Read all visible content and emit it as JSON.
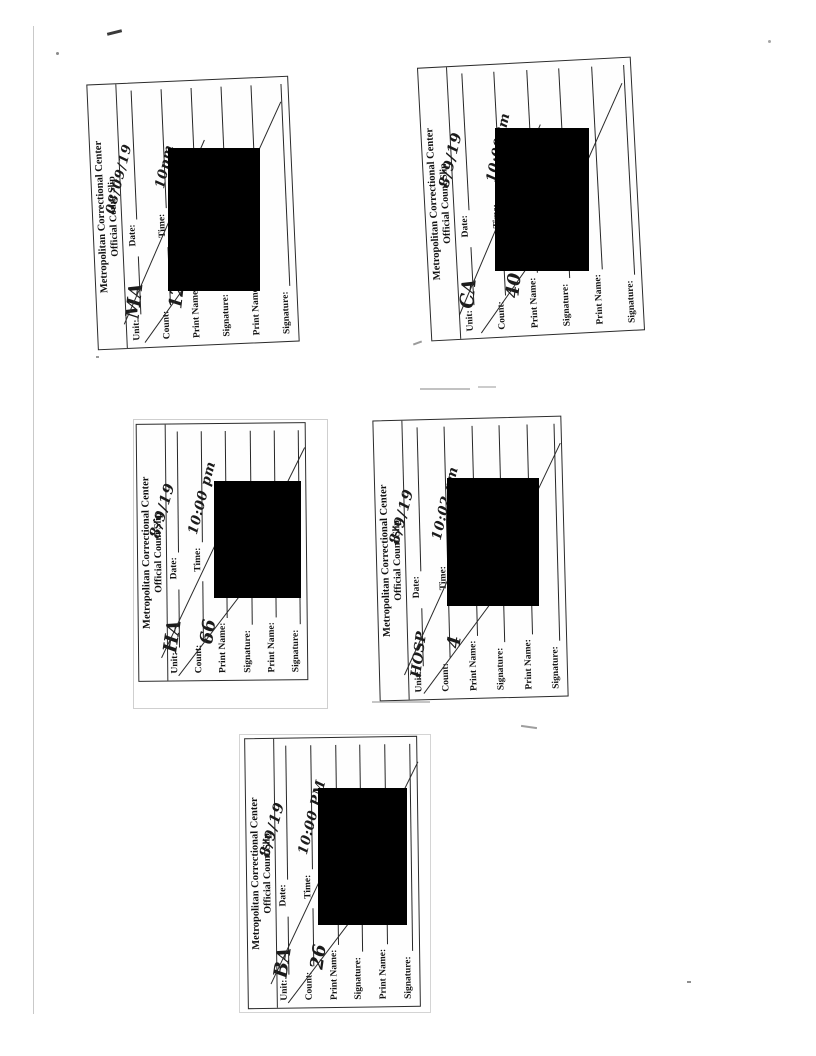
{
  "slip": {
    "header_line1": "Metropolitan Correctional Center",
    "header_line2": "Official Count Slip",
    "labels": {
      "unit": "Unit:",
      "date": "Date:",
      "count": "Count:",
      "time": "Time:",
      "print_name": "Print Name:",
      "signature": "Signature:"
    }
  },
  "slips": [
    {
      "unit": "MA",
      "count": "125",
      "date": "08/09/19",
      "time": "10pm"
    },
    {
      "unit": "CA",
      "count": "40",
      "date": "8/9/19",
      "time": "10:00Pm"
    },
    {
      "unit": "HA",
      "count": "66",
      "date": "8/9/19",
      "time": "10:00 pm"
    },
    {
      "unit": "HOSP",
      "count": "4",
      "date": "8/9/19",
      "time": "10:02 pm"
    },
    {
      "unit": "BA",
      "count": "26",
      "date": "8/9/19",
      "time": "10:00 PM"
    }
  ],
  "colors": {
    "redaction": "#000000",
    "ink": "#1b1b1b",
    "paper": "#ffffff"
  }
}
